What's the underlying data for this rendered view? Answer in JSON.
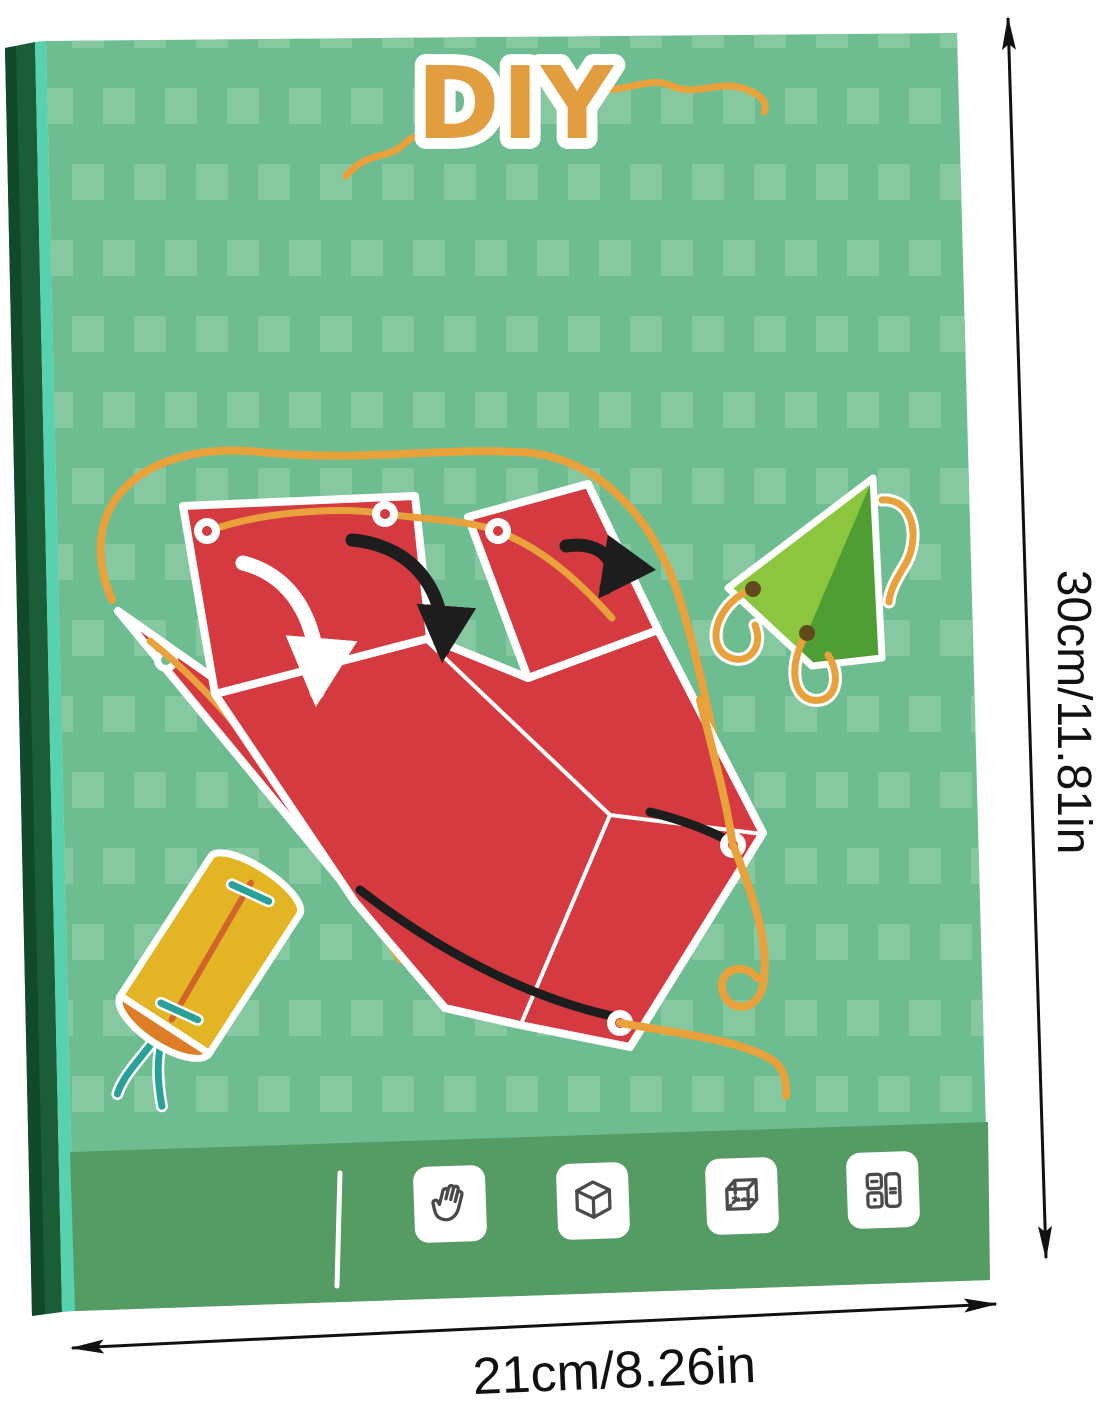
{
  "box": {
    "title": "DIY",
    "pieces": [
      "red-unfolded-box-template",
      "green-paper-pyramid",
      "yellow-paper-cylinder",
      "orange-lacing-string"
    ],
    "footer": {
      "icons": [
        "hand-icon",
        "cube-icon",
        "transparent-cube-icon",
        "split-panels-icon"
      ]
    }
  },
  "dimensions": {
    "height": "30cm/11.81in",
    "width": "21cm/8.26in"
  },
  "colors": {
    "face": "#6ebd90",
    "square": "#86c9a1",
    "band": "#549b64",
    "spine": "#1a5d37",
    "spine_dark": "#114a2a",
    "teal_edge": "#57d1ae",
    "title": "#e29e3e",
    "string": "#e9a13b",
    "red": "#d53a40",
    "pyramid_light": "#8cc63f",
    "pyramid_dark": "#4f9e33",
    "cylinder_yellow": "#e3b424",
    "cylinder_cap": "#dd7e27",
    "cylinder_line": "#d0642a",
    "stitch": "#2aa198",
    "hole": "#5e4a1d",
    "arrow_black": "#1d1d1d",
    "icon_stroke": "#4a4a4a",
    "dim": "#111111"
  }
}
